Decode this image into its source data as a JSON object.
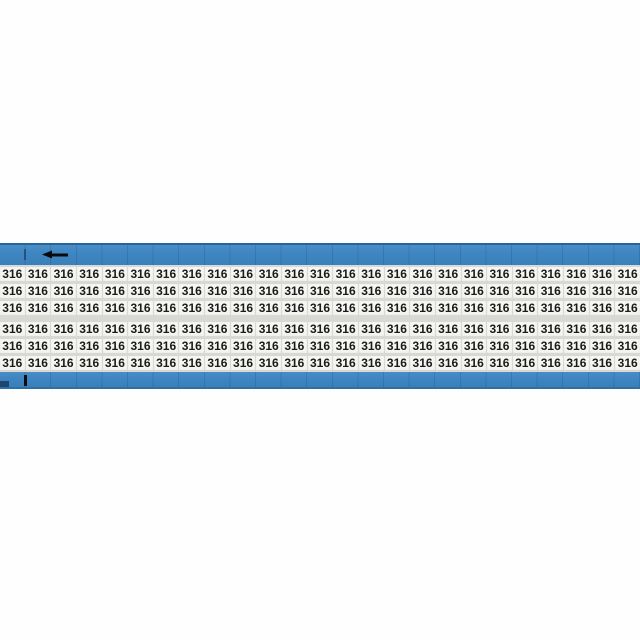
{
  "product": {
    "marker_value": "316",
    "grid": {
      "columns": 25,
      "rows": 6,
      "rows_per_bank": 3,
      "banks": 2
    },
    "icons": {
      "direction_arrow": "left-arrow"
    },
    "colors": {
      "card_blue": "#3E86C2",
      "card_edge_dark": "#26659C",
      "label_area_bg": "#D8D8D4",
      "cell_bg": "#F5F5F2",
      "marker_text": "#1B1B1B",
      "arrow_black": "#0B0B0D"
    }
  }
}
